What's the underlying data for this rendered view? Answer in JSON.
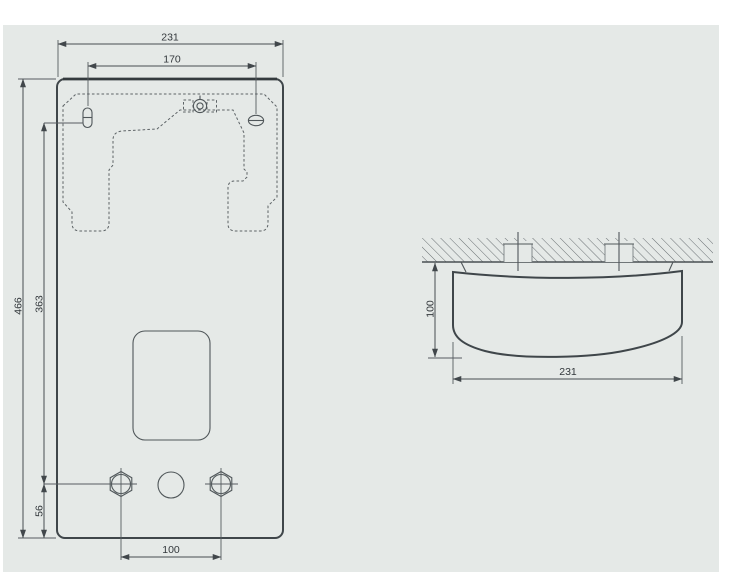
{
  "drawing": {
    "type": "technical dimension drawing - wall hung appliance, front view and top view",
    "front_view": {
      "dim_overall_width": "231",
      "dim_mounting_holes_width": "170",
      "dim_overall_height": "466",
      "dim_hanger_to_connections": "363",
      "dim_connections_to_bottom": "56",
      "dim_connection_spacing": "100"
    },
    "side_view": {
      "dim_depth": "100",
      "dim_width": "231"
    }
  },
  "colors": {
    "panel_background": "#e5e9e7",
    "outline": "#3f464a",
    "dimension_line": "#474d51",
    "dashed_template": "#5d6366",
    "dimension_text": "#33383c",
    "page_background": "#ffffff"
  }
}
